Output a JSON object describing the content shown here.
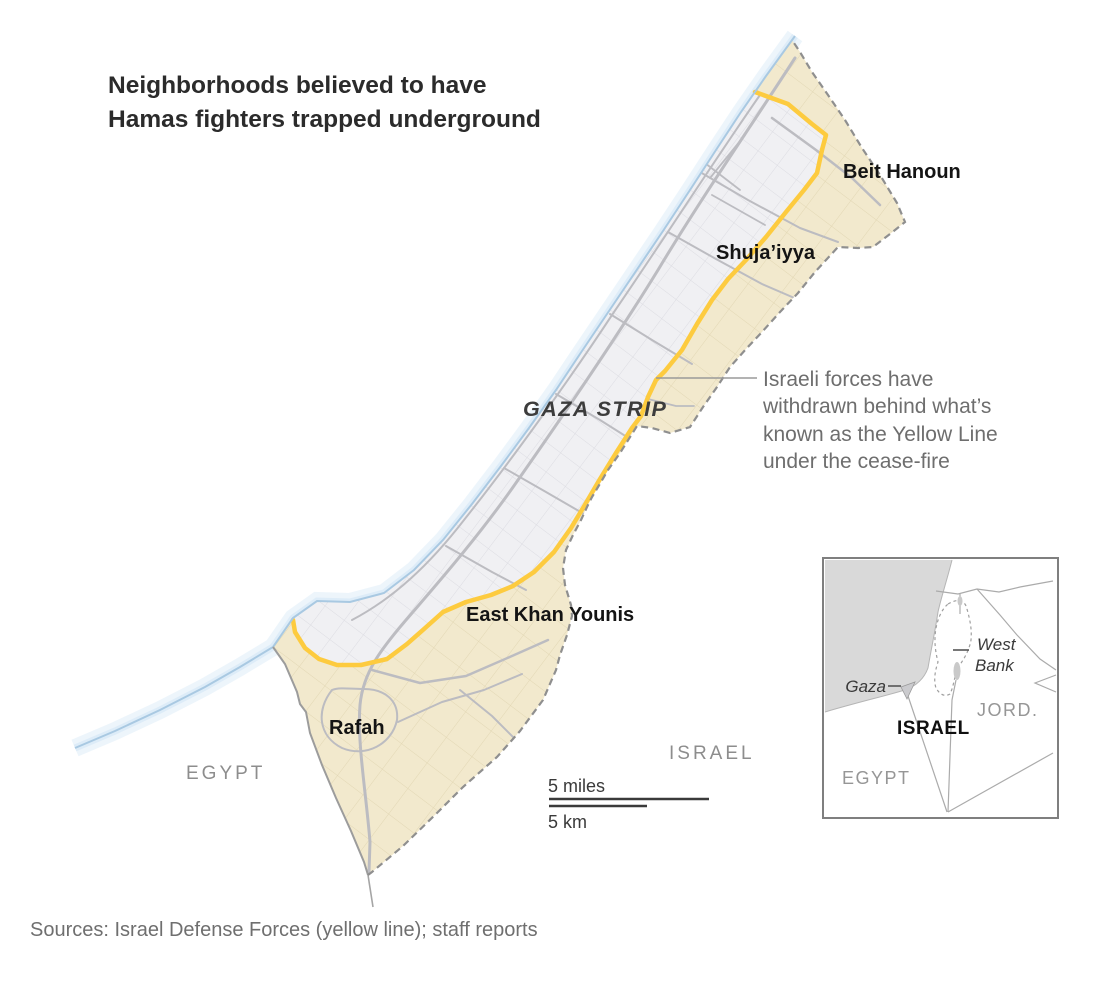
{
  "title": {
    "lines": [
      "Neighborhoods believed to have",
      "Hamas fighters trapped underground"
    ]
  },
  "map_labels": {
    "region": "GAZA STRIP",
    "beit_hanoun": "Beit Hanoun",
    "shujaiyya": "Shuja’iyya",
    "east_khan_younis": "East Khan Younis",
    "rafah": "Rafah",
    "egypt": "EGYPT",
    "israel": "ISRAEL"
  },
  "annotation": {
    "lines": [
      "Israeli forces have",
      "withdrawn behind what’s",
      "known as the Yellow Line",
      "under the cease-fire"
    ]
  },
  "scale_bar": {
    "miles_label": "5 miles",
    "km_label": "5 km"
  },
  "inset": {
    "gaza": "Gaza",
    "west_bank_lines": [
      "West",
      "Bank"
    ],
    "israel": "ISRAEL",
    "jordan": "JORD.",
    "egypt": "EGYPT"
  },
  "source_line": "Sources: Israel Defense Forces (yellow line); staff reports",
  "colors": {
    "yellow_line": "#fdcb3f",
    "ceded_area": "#f2e9cd",
    "ceded_area_lines": "#e2d7b4",
    "urban_area": "#f0f0f3",
    "urban_area_lines": "#dcdce2",
    "roads": "#bcbcc1",
    "border_dash": "#8f8f8f",
    "egypt_border": "#9c9c9c",
    "coast_line": "#a9c9e2",
    "coast_glow": "#cfe4f5",
    "inset_sea": "#d9d9d9"
  }
}
